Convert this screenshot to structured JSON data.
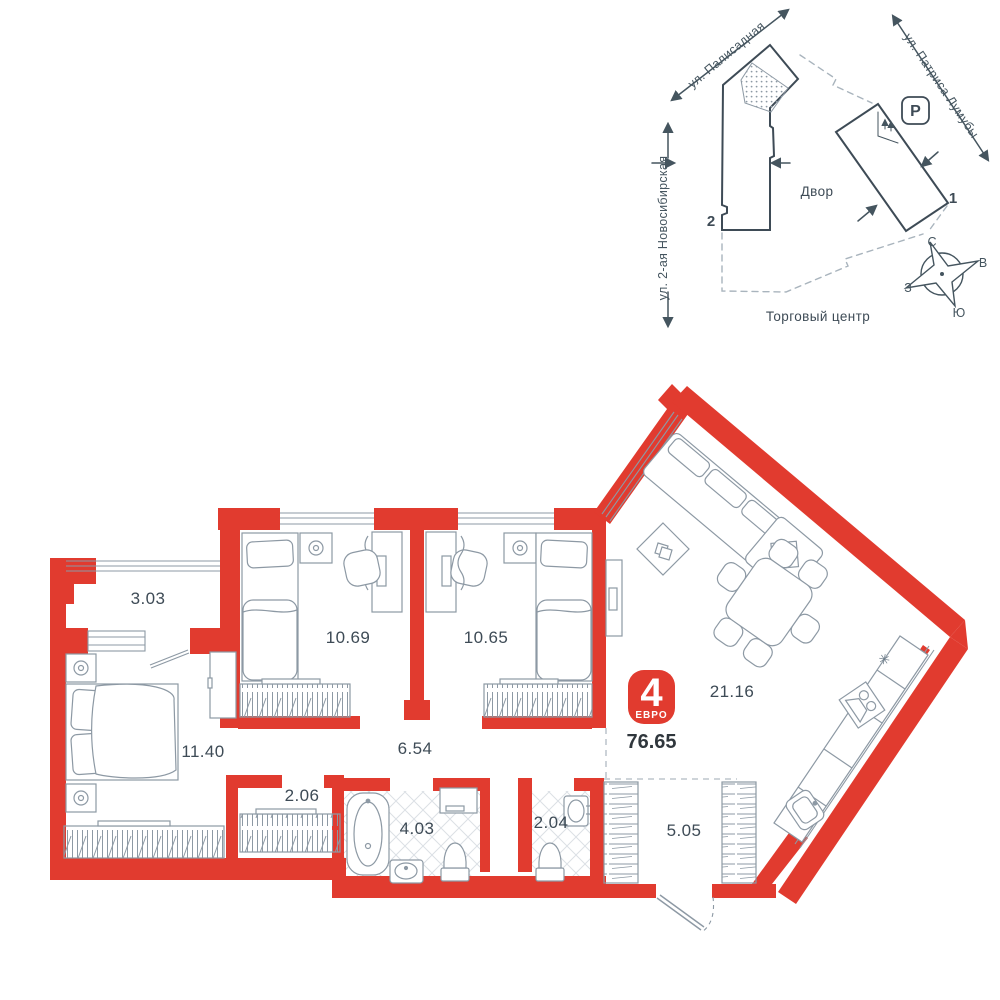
{
  "floor_plan": {
    "badge": {
      "rooms_count": "4",
      "type_label": "ЕВРО",
      "total_area": "76.65",
      "color": "#e13b2f"
    },
    "rooms": [
      {
        "id": "balcony",
        "area": "3.03"
      },
      {
        "id": "bedroom-master",
        "area": "11.40"
      },
      {
        "id": "bedroom-2",
        "area": "10.69"
      },
      {
        "id": "bedroom-3",
        "area": "10.65"
      },
      {
        "id": "hallway",
        "area": "6.54"
      },
      {
        "id": "closet",
        "area": "2.06"
      },
      {
        "id": "bathroom",
        "area": "4.03"
      },
      {
        "id": "wc",
        "area": "2.04"
      },
      {
        "id": "entry-hall",
        "area": "5.05"
      },
      {
        "id": "kitchen-living",
        "area": "21.16"
      }
    ],
    "colors": {
      "wall": "#e13b2f",
      "furniture_line": "#8d99a4",
      "text": "#3e4b56"
    },
    "icons": {
      "fridge_snowflake": "✳"
    }
  },
  "site_plan": {
    "streets": [
      "ул. Палисадная",
      "ул. Патриса Лумубы",
      "ул. 2-ая Новосибирская"
    ],
    "labels": {
      "yard": "Двор",
      "mall": "Торговый центр",
      "parking": "P"
    },
    "buildings": [
      {
        "number": "1"
      },
      {
        "number": "2"
      }
    ],
    "compass": {
      "north": "С",
      "east": "В",
      "south": "Ю",
      "west": "З"
    }
  }
}
